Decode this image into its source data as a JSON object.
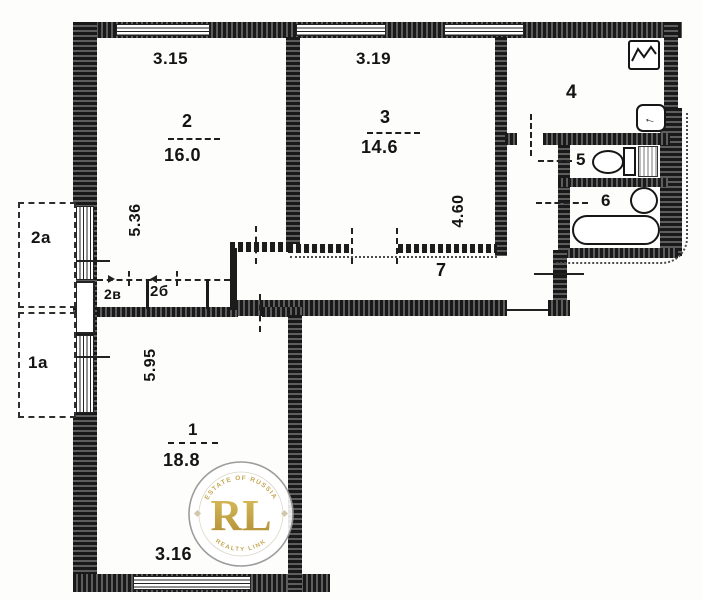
{
  "floorplan": {
    "rooms": {
      "living1": {
        "number": "1",
        "area": "18.8"
      },
      "living2": {
        "number": "2",
        "area": "16.0"
      },
      "living3": {
        "number": "3",
        "area": "14.6"
      },
      "kitchen": {
        "number": "4"
      },
      "wc": {
        "number": "5"
      },
      "bath": {
        "number": "6"
      },
      "hall": {
        "number": "7"
      }
    },
    "dimensions": {
      "room2_width": "3.15",
      "room2_depth": "5.36",
      "room3_width": "3.19",
      "room3_depth": "4.60",
      "room1_width": "3.16",
      "room1_depth": "5.95"
    },
    "balconies": {
      "b2a": "2а",
      "b1a": "1а"
    },
    "closets": {
      "c2v": "2в",
      "c2b": "2б"
    }
  },
  "watermark": {
    "initials": "RL",
    "arc_top": "ESTATE OF RUSSIA",
    "arc_bottom": "REALTY LINK",
    "gold": "#c3a44e"
  },
  "colors": {
    "line": "#1b1b1b",
    "paper": "#fdfdfb"
  }
}
